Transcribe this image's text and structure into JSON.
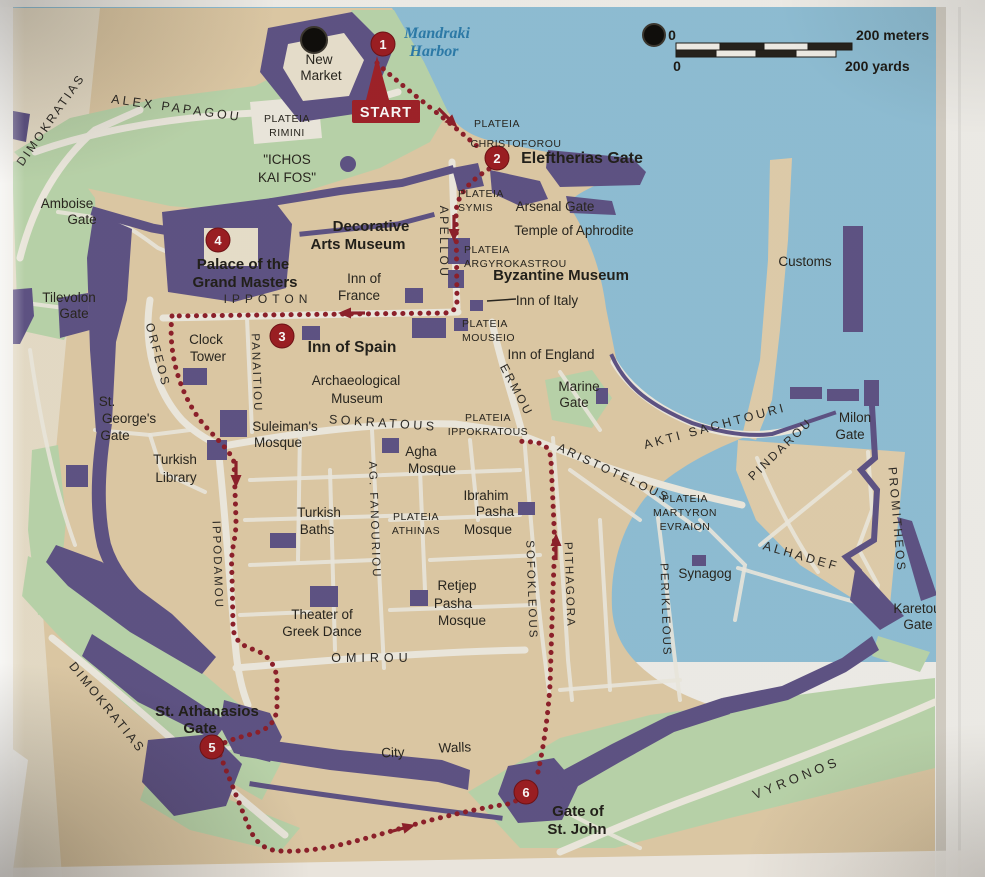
{
  "colors": {
    "sea": "#90c2da",
    "land_tan": "#e1cda9",
    "green": "#bcd8ae",
    "wall_purple": "#5e5387",
    "street_white": "#f1eee4",
    "route_red": "#8e1e2a",
    "marker_red": "#9d1c22",
    "label_black": "#26241e",
    "harbor_blue_text": "#2a7cad",
    "paper": "#f3f2ee"
  },
  "scale_bar": {
    "zero_top": "0",
    "meters_label": "200 meters",
    "zero_bottom": "0",
    "yards_label": "200 yards"
  },
  "route": {
    "start_label": "START",
    "markers": [
      "1",
      "2",
      "3",
      "4",
      "5",
      "6"
    ]
  },
  "streets": {
    "dimokratias_top": "DIMOKRATIAS",
    "alex_papagou": "ALEX PAPAGOU",
    "apellou": "APELLOU",
    "ippoton": "IPPOTON",
    "orfeos": "ORFEOS",
    "panaitiou": "PANAITIOU",
    "sokratous": "SOKRATOUS",
    "ag_fanouriou": "AG. FANOURIOU",
    "ermou": "ERMOU",
    "sofokleous": "SOFOKLEOUS",
    "pithagora": "PITHAGORA",
    "aristotelous": "ARISTOTELOUS",
    "perikleous": "PERIKLEOUS",
    "pindarou": "PINDAROU",
    "alhadef": "ALHADEF",
    "akti_sachtouri": "AKTI SACHTOURI",
    "promitheos": "PROMITHEOS",
    "omirou": "OMIROU",
    "ippodamou": "IPPODAMOU",
    "dimokratias_bottom": "DIMOKRATIAS",
    "vyronos": "VYRONOS"
  },
  "plateias": {
    "rimini": {
      "l1": "PLATEIA",
      "l2": "RIMINI"
    },
    "christoforou": {
      "l1": "PLATEIA",
      "l2": "CHRISTOFOROU"
    },
    "symis": {
      "l1": "PLATEIA",
      "l2": "SYMIS"
    },
    "argyrokastrou": {
      "l1": "PLATEIA",
      "l2": "ARGYROKASTROU"
    },
    "mouseio": {
      "l1": "PLATEIA",
      "l2": "MOUSEIO"
    },
    "ippokratous": {
      "l1": "PLATEIA",
      "l2": "IPPOKRATOUS"
    },
    "martyron": {
      "l1": "PLATEIA",
      "l2": "MARTYRON",
      "l3": "EVRAION"
    },
    "athinas": {
      "l1": "PLATEIA",
      "l2": "ATHINAS"
    }
  },
  "pois": {
    "mandraki": {
      "l1": "Mandraki",
      "l2": "Harbor"
    },
    "new_market": {
      "l1": "New",
      "l2": "Market"
    },
    "ichos": {
      "l1": "\"ICHOS",
      "l2": "KAI FOS\""
    },
    "amboise": {
      "l1": "Amboise",
      "l2": "Gate"
    },
    "tilevolon": {
      "l1": "Tilevolon",
      "l2": "Gate"
    },
    "st_georges": {
      "l1": "St.",
      "l2": "George's",
      "l3": "Gate"
    },
    "turkish_library": {
      "l1": "Turkish",
      "l2": "Library"
    },
    "clock_tower": {
      "l1": "Clock",
      "l2": "Tower"
    },
    "suleimans": {
      "l1": "Suleiman's",
      "l2": "Mosque"
    },
    "palace": {
      "l1": "Palace of the",
      "l2": "Grand Masters"
    },
    "decorative": {
      "l1": "Decorative",
      "l2": "Arts Museum"
    },
    "inn_france": {
      "l1": "Inn of",
      "l2": "France"
    },
    "eleftherias": "Eleftherias Gate",
    "arsenal": "Arsenal Gate",
    "aphrodite": "Temple of Aphrodite",
    "byzantine": "Byzantine Museum",
    "inn_italy": "Inn of Italy",
    "inn_england": "Inn of England",
    "marine": {
      "l1": "Marine",
      "l2": "Gate"
    },
    "inn_spain": "Inn of Spain",
    "arch_museum": {
      "l1": "Archaeological",
      "l2": "Museum"
    },
    "agha": {
      "l1": "Agha",
      "l2": "Mosque"
    },
    "turkish_baths": {
      "l1": "Turkish",
      "l2": "Baths"
    },
    "ibrahim": {
      "l1": "Ibrahim",
      "l2": "Pasha",
      "l3": "Mosque"
    },
    "retjep": {
      "l1": "Retjep",
      "l2": "Pasha",
      "l3": "Mosque"
    },
    "theater": {
      "l1": "Theater of",
      "l2": "Greek Dance"
    },
    "customs": "Customs",
    "milon": {
      "l1": "Milon",
      "l2": "Gate"
    },
    "synagog": "Synagog",
    "karetou": {
      "l1": "Karetou",
      "l2": "Gate"
    },
    "st_athanasios": {
      "l1": "St. Athanasios",
      "l2": "Gate"
    },
    "city_walls": {
      "l1": "City",
      "l2": "Walls"
    },
    "st_john": {
      "l1": "Gate of",
      "l2": "St. John"
    }
  }
}
